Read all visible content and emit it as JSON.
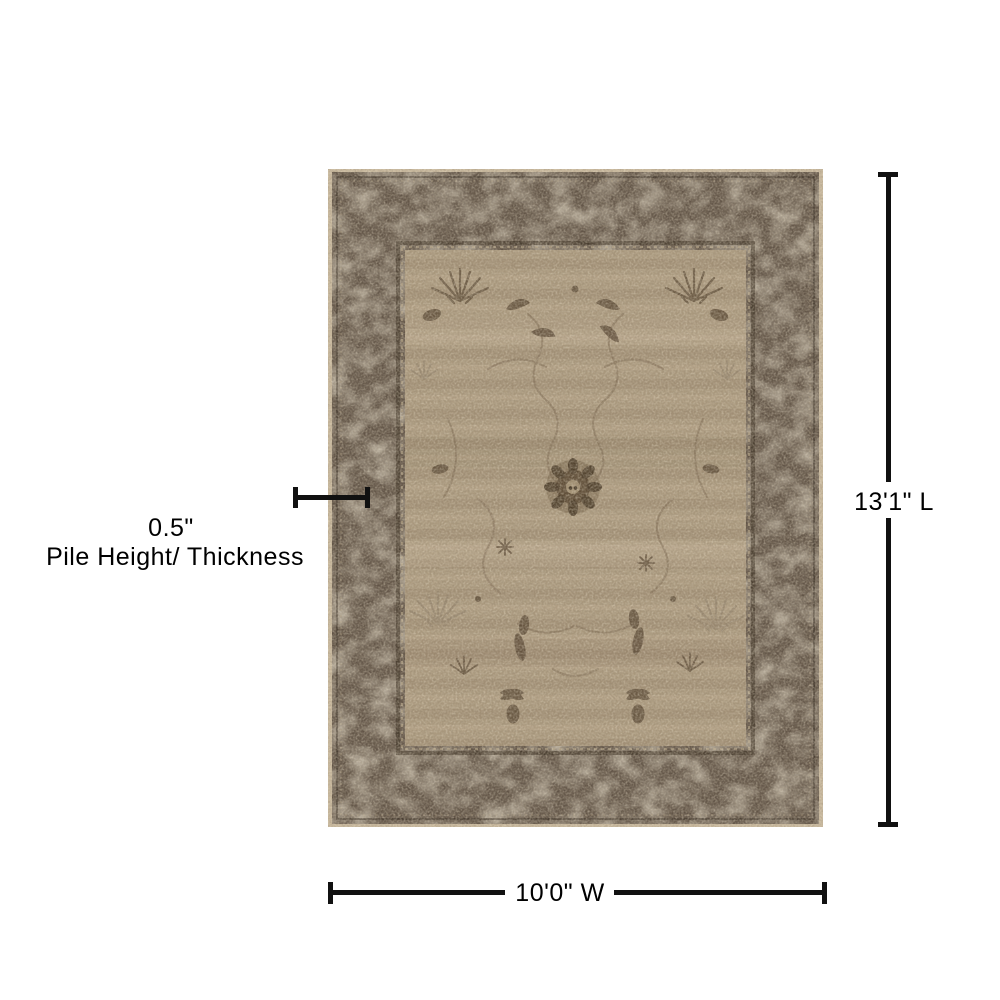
{
  "page": {
    "background_color": "#ffffff"
  },
  "rug": {
    "description": "area-rug-photo",
    "colors": {
      "edge": "#c9b99e",
      "border": "#615447",
      "border_motif": "#97866f",
      "field": "#aa997e",
      "motif_dark": "#584734",
      "tracery": "#77644d"
    }
  },
  "dimensions": {
    "line_color": "#111111",
    "length_label": "13'1\" L",
    "width_label": "10'0\" W",
    "pile_value": "0.5\"",
    "pile_caption": "Pile Height/ Thickness"
  }
}
